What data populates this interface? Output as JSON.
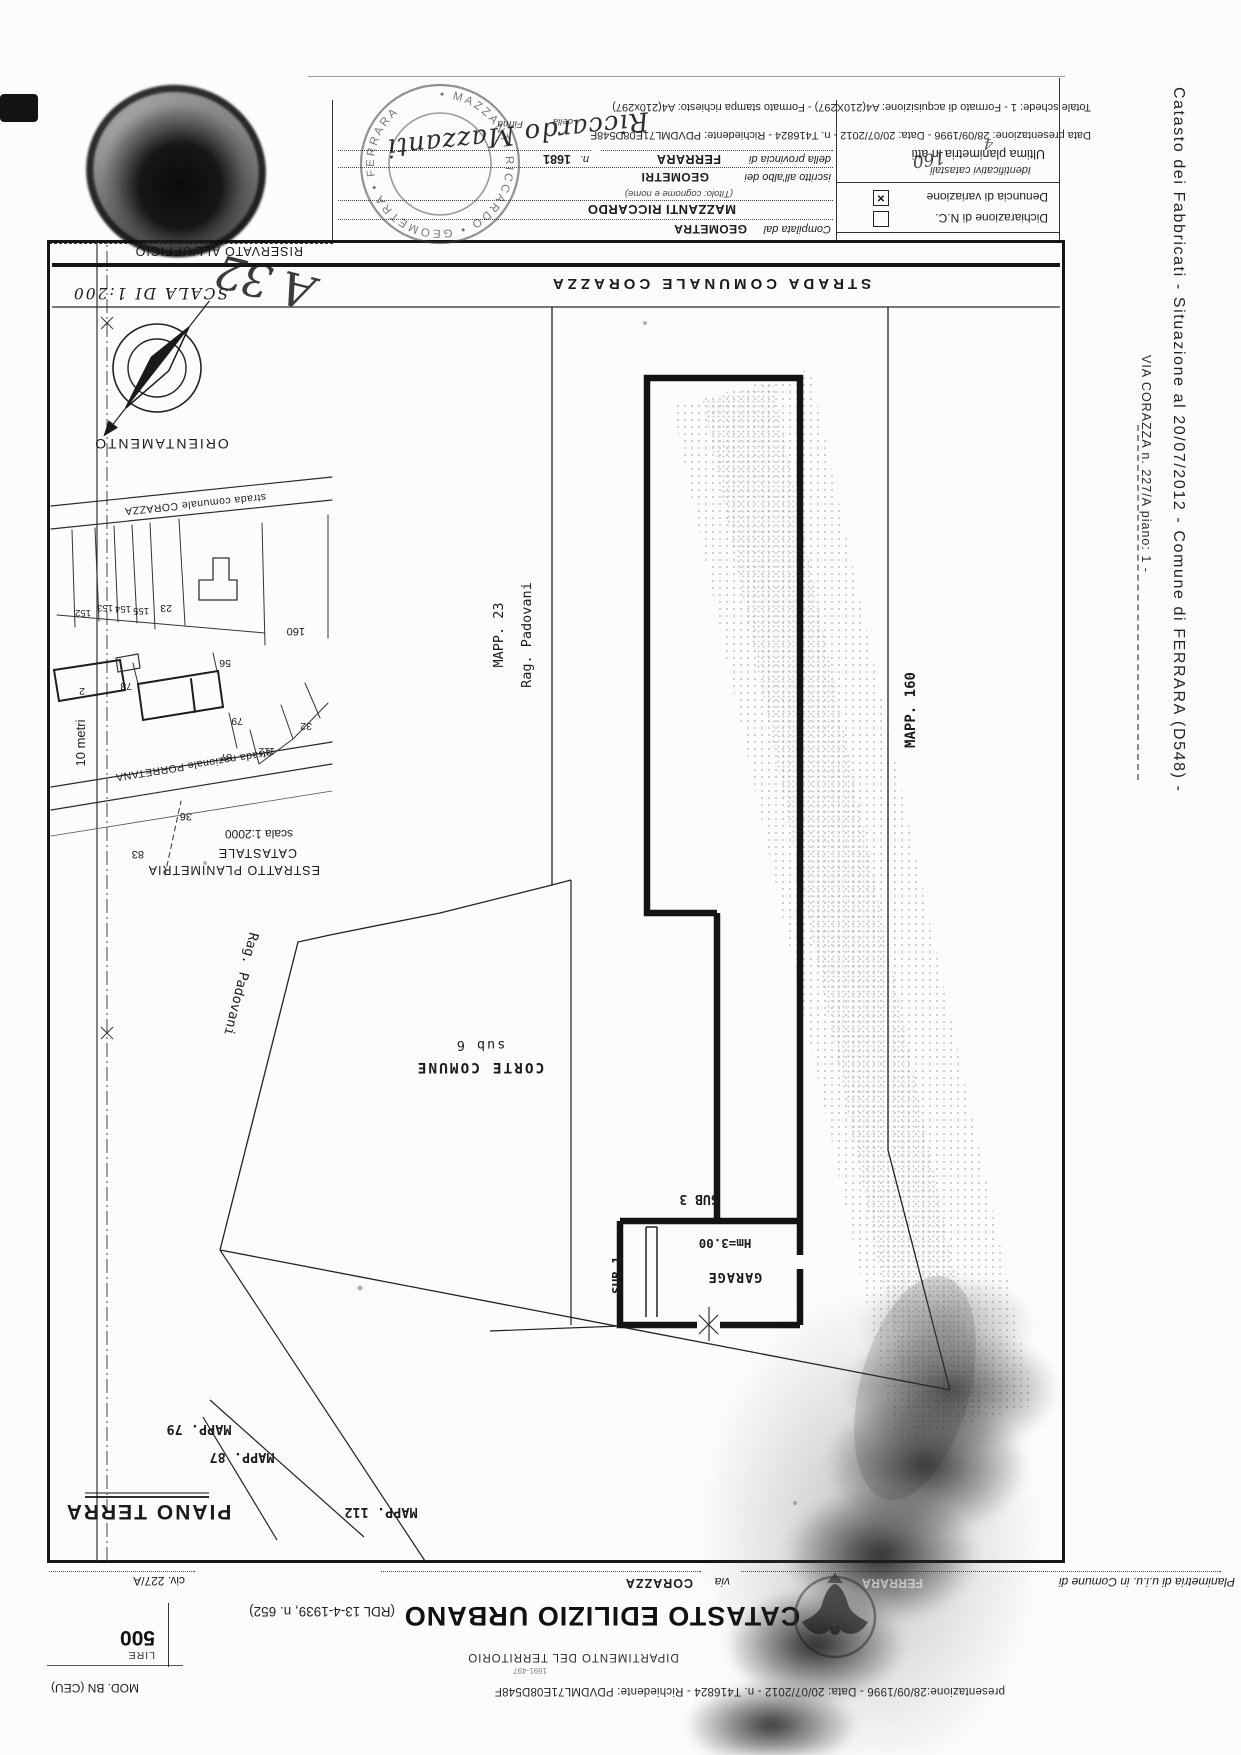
{
  "margin": {
    "line1": "Catasto dei Fabbricati - Situazione al 20/07/2012 - Comune di FERRARA (D548) -",
    "line2": "VIA CORAZZA n. 227/A piano: 1 -"
  },
  "title_block": {
    "presentazione_line": "presentazione:28/09/1996 - Data: 20/07/2012 - n. T416824 - Richiedente: PDVDML71E08D548F",
    "mod": "MOD. BN (CEU)",
    "small_ref": "1691-497",
    "dipartimento": "DIPARTIMENTO DEL TERRITORIO",
    "title": "CATASTO EDILIZIO URBANO",
    "rdl": "(RDL 13-4-1939, n. 652)",
    "lire_label": "LIRE",
    "lire_value": "500",
    "planimetria_label": "Planimetria di u.i.u. in Comune di",
    "comune_value": "FERRARA",
    "via_label": "via",
    "via_value": "CORAZZA",
    "civ": "civ. 227/A"
  },
  "plan": {
    "strada": "STRADA COMUNALE CORAZZA",
    "piano_terra": "PIANO TERRA",
    "mapp79": "MAPP. 79",
    "mapp87": "MAPP. 87",
    "mapp112": "MAPP. 112",
    "mapp160": "MAPP. 160",
    "rag_padovani_v": "Rag. Padovani",
    "mapp23": "MAPP. 23",
    "rag_padovani_d": "Rag. Padovani",
    "corte": "CORTE COMUNE",
    "sub6": "sub 6",
    "sub3": "SUB 3",
    "sub1": "SUB 1",
    "garage": "GARAGE",
    "hm": "Hm=3.00",
    "ten_metri": "10 metri",
    "orientamento": "ORIENTAMENTO",
    "scala": "SCALA DI 1:200"
  },
  "inset": {
    "caption1": "ESTRATTO PLANIMETRIA",
    "caption2": "CATASTALE",
    "caption3": "scala 1:2000",
    "road1": "strada nazionale PORRETANA",
    "road2": "strada comunale CORAZZA",
    "k152": "152",
    "k153": "153",
    "k154": "154",
    "k155": "155",
    "k23": "23",
    "k56": "56",
    "k160": "160",
    "k2": "2",
    "k78": "78",
    "k79": "79",
    "k87": "87",
    "k112": "112",
    "k32": "32",
    "k36": "36",
    "k83": "83"
  },
  "form": {
    "riservato": "RISERVATO ALL'UFFICIO",
    "compilata": "Compilata dal",
    "geometra": "GEOMETRA",
    "nome": "MAZZANTI RICCARDO",
    "titolo_note": "(Titolo: cognome e nome)",
    "iscritto": "iscritto all'albo dei",
    "albo": "GEOMETRI",
    "provincia_label": "della provincia di",
    "provincia": "FERRARA",
    "n_label": "n.",
    "n_value": "1681",
    "della": "della",
    "firma": "Firma",
    "signature": "Riccardo Mazzanti",
    "data_line": "Data presentazione: 28/09/1996 - Data: 20/07/2012 - n. T416824 - Richiedente: PDVDML71E08D548F",
    "totale_line": "Totale schede: 1 - Formato di acquisizione: A4(210X297) - Formato stampa richiesto: A4(210x297)",
    "dichiarazione": "Dichiarazione di N.C.",
    "denuncia": "Denuncia di variazione",
    "check_mark": "×",
    "identificativi": "Identificativi catastali",
    "ultima": "Ultima planimetria in atti",
    "hand_160": "160",
    "hand_4": "4",
    "hand_a32": "A 32",
    "stamp_ring": "• MAZZANTI RICCARDO • GEOMETRA • FERRARA"
  }
}
